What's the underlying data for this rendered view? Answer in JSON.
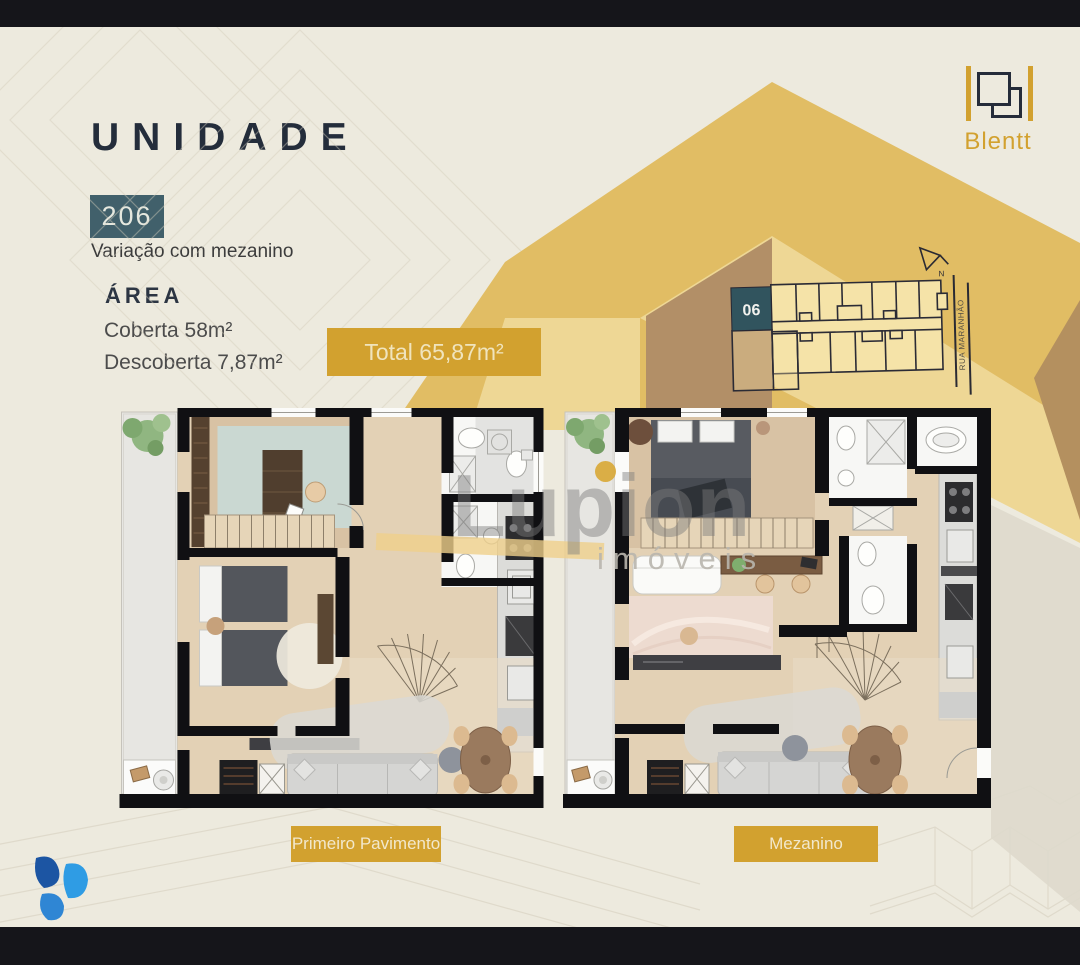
{
  "header": {
    "title": "UNIDADE",
    "unit_number": "206",
    "variation": "Variação com mezanino"
  },
  "area": {
    "heading": "ÁREA",
    "coberta": "Coberta 58m²",
    "descoberta": "Descoberta 7,87m²",
    "total_badge": "Total 65,87m²"
  },
  "brand": {
    "name": "Blentt"
  },
  "keyplan": {
    "highlight_unit": "06",
    "street_name": "RUA MARANHÃO",
    "north_label": "N"
  },
  "floorplans": {
    "first_label": "Primeiro Pavimento",
    "second_label": "Mezanino"
  },
  "watermark": {
    "brand": "Lupion",
    "suffix": "imóveis"
  },
  "colors": {
    "accent_gold": "#d2a12f",
    "unit_badge_teal": "#41606b",
    "title_navy": "#242d3b",
    "mustard": "#e1bd64",
    "light_gold": "#eed795",
    "face_brown": "#b28f67",
    "keyplan_fill": "#f5e3a8",
    "logo_blue_dark": "#1c55a3",
    "logo_blue_light": "#2f9ce4",
    "logo_blue_mid": "#2f7dd1"
  }
}
